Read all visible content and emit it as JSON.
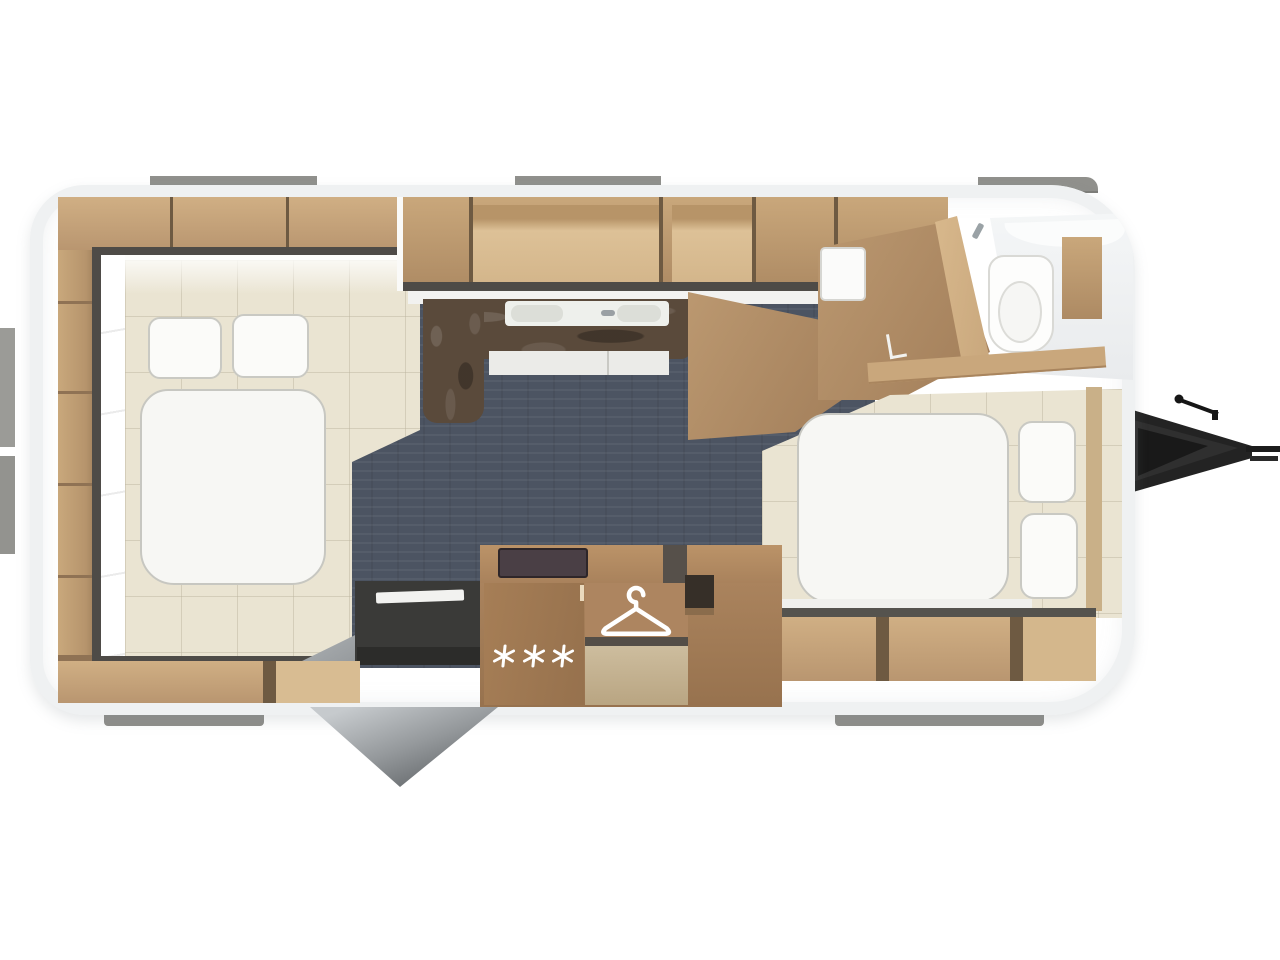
{
  "meta": {
    "title": "Caravan floor plan — top view",
    "description": "3D top-down floor plan rendering of a single-axle travel trailer"
  },
  "regions": {
    "body": {
      "label": "Caravan body shell"
    },
    "rear_bedroom": {
      "label": "Rear bedroom with double bed, two pillows and wardrobes"
    },
    "kitchen": {
      "label": "Kitchen block with sink and dark worktop"
    },
    "entry": {
      "label": "Entry door shown open"
    },
    "wardrobe": {
      "label": "Wardrobe with clothes hanger symbol"
    },
    "fridge": {
      "label": "Refrigerator with snowflake symbols"
    },
    "front_bedroom": {
      "label": "Front bedroom with double bed and two pillows"
    },
    "bathroom": {
      "label": "Washroom with toilet"
    },
    "hitch": {
      "label": "Tow hitch drawbar"
    }
  },
  "icons": {
    "hanger": {
      "name": "hanger-icon",
      "meaning": "wardrobe",
      "count": 1
    },
    "snowflake": {
      "name": "snowflake-icon",
      "meaning": "refrigerator",
      "count": 3
    }
  },
  "colors": {
    "floor_dark": "#4c5462",
    "floor_beige": "#eae4d2",
    "wood": "#c2a077",
    "wood_dark": "#a9855e",
    "counter_marble": "#5a4a3b",
    "soft_white": "#f6f6f3",
    "wall_frame": "#4e4b47",
    "exterior_fitting": "#90908c",
    "hitch": "#222222"
  }
}
